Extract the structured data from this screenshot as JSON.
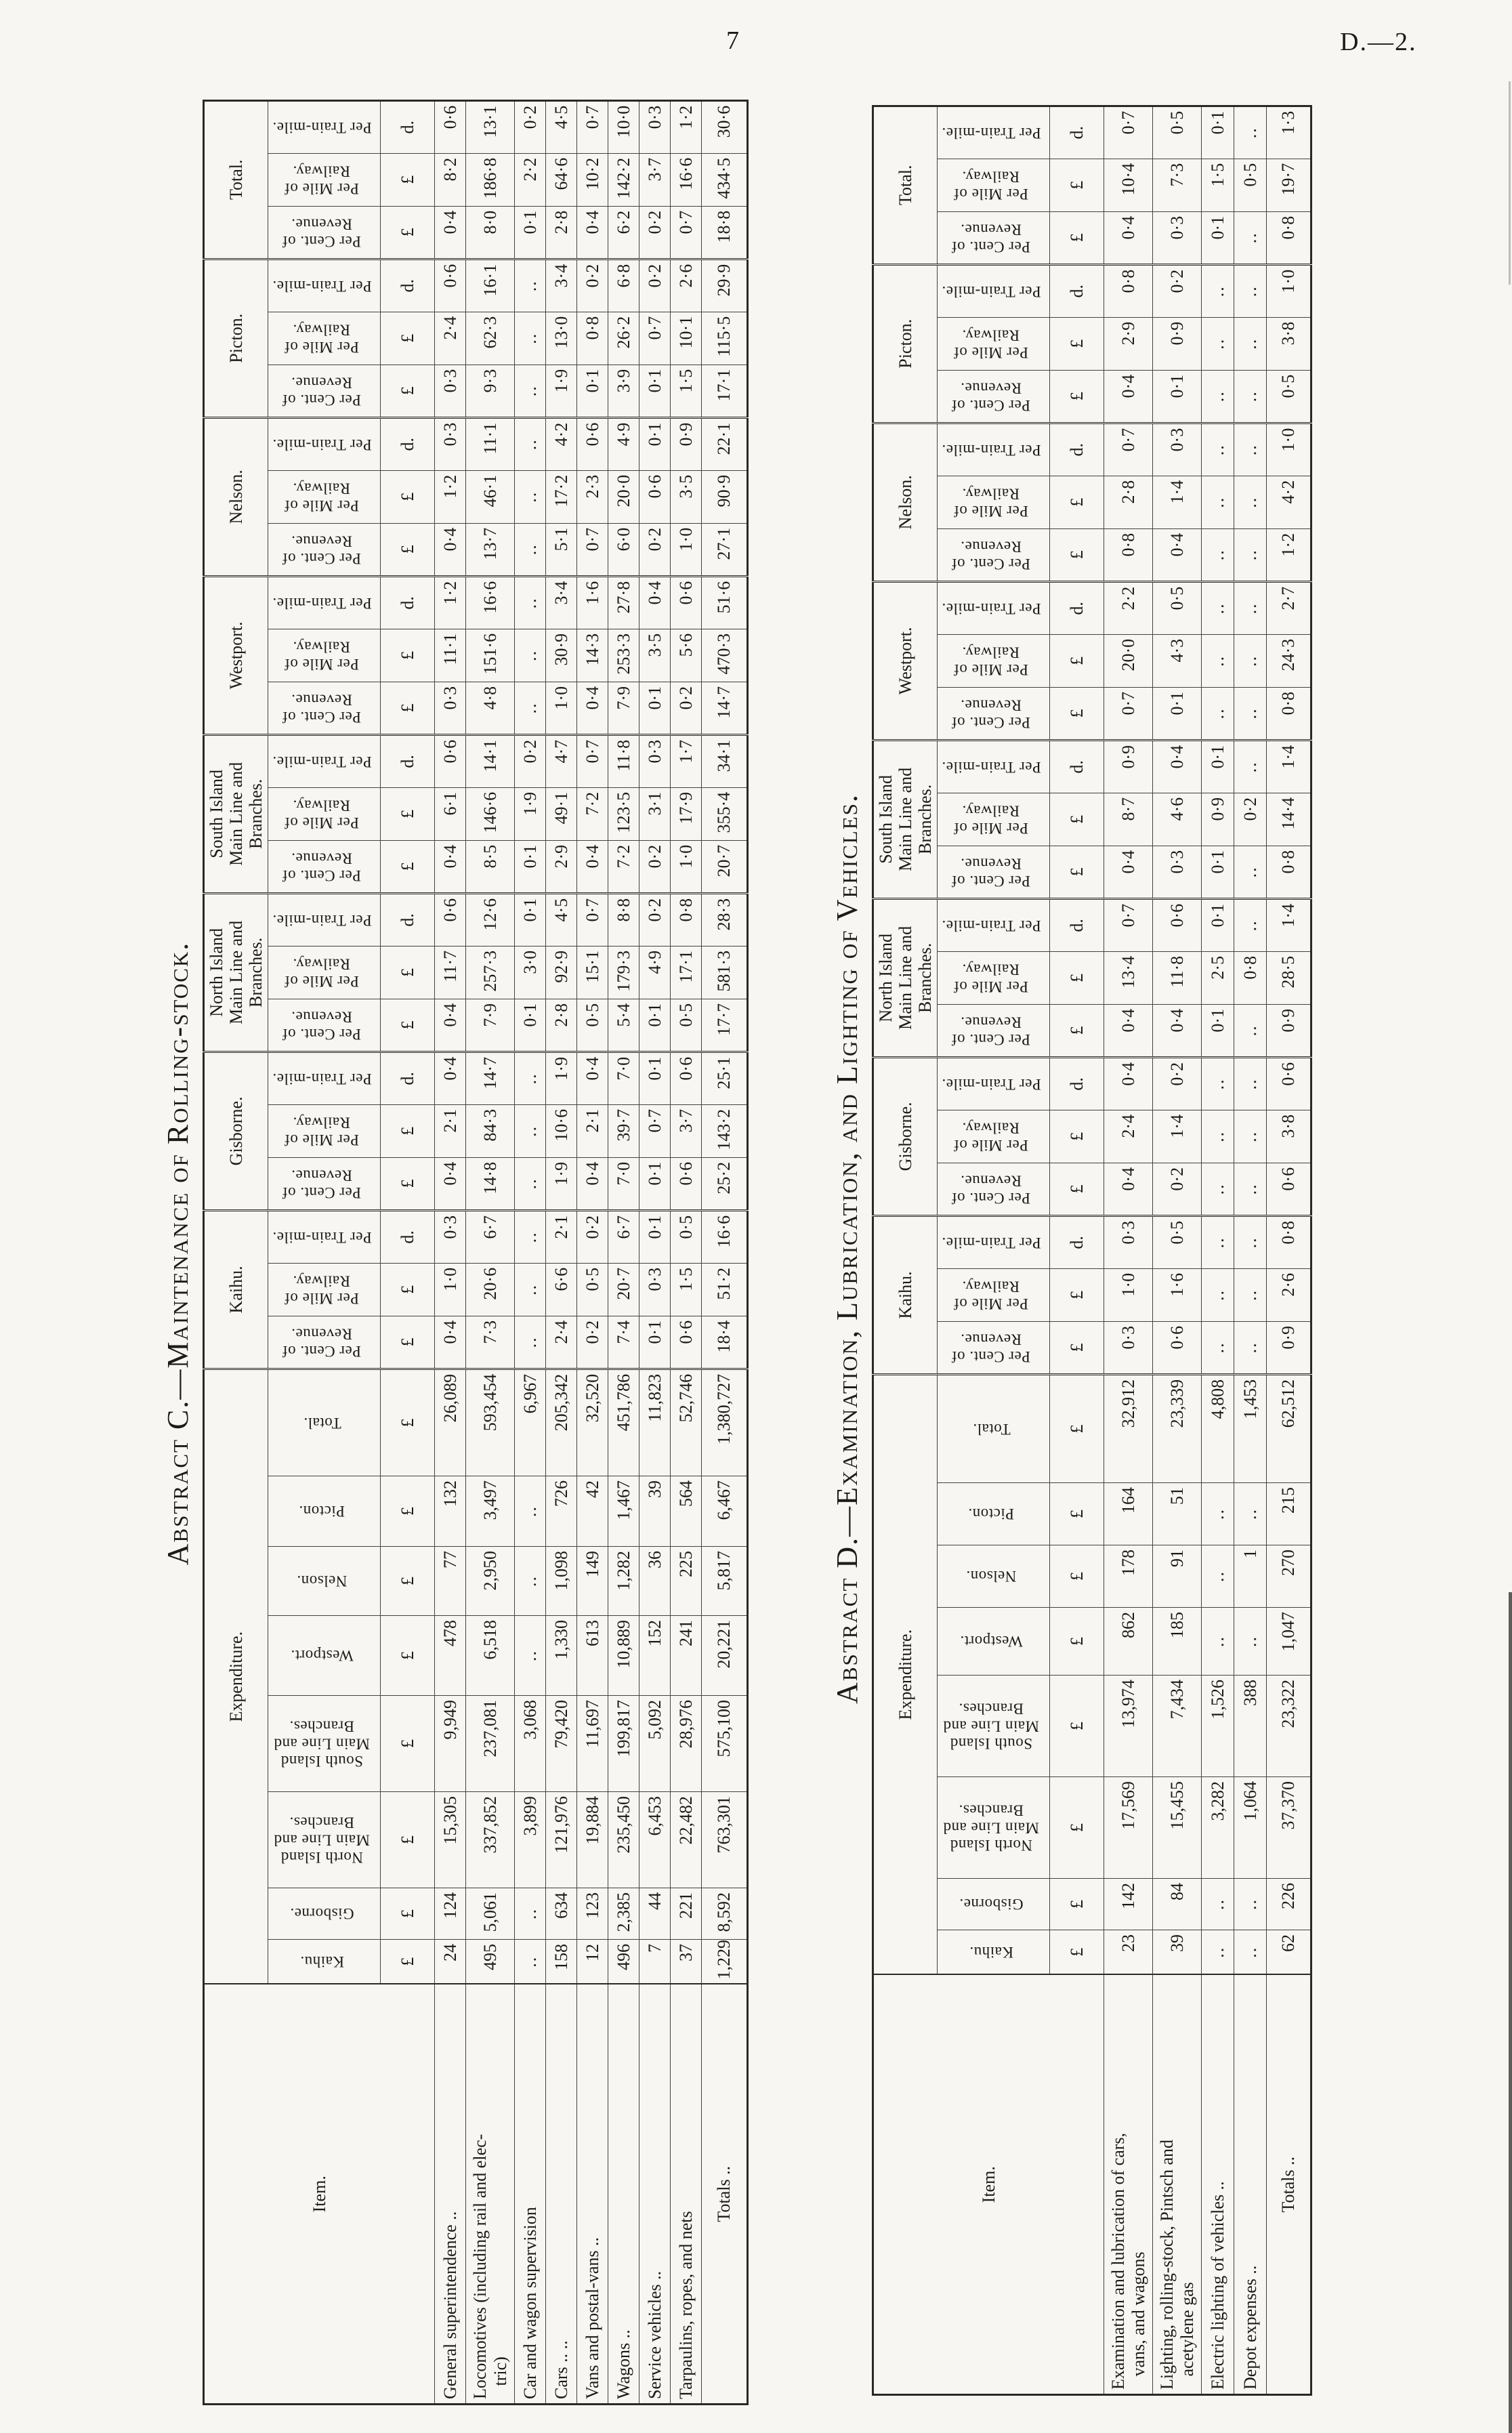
{
  "page": {
    "number": "7",
    "doc_ref": "D.—2."
  },
  "abstract_c": {
    "title": "Abstract C.—Maintenance of Rolling-stock.",
    "item_header": "Item.",
    "expenditure_header": "Expenditure.",
    "unit_pound": "£",
    "unit_pence": "d.",
    "blank": "..",
    "exp_columns": [
      "Kaihu.",
      "Gisborne.",
      "North Island\nMain Line and\nBranches.",
      "South Island\nMain Line and\nBranches.",
      "Westport.",
      "Nelson.",
      "Picton.",
      "Total."
    ],
    "ratio_groups": [
      "Kaihu.",
      "Gisborne.",
      "North Island\nMain Line and\nBranches.",
      "South Island\nMain Line and\nBranches.",
      "Westport.",
      "Nelson.",
      "Picton.",
      "Total."
    ],
    "ratio_subheaders": [
      "Per Cent. of Revenue.",
      "Per Mile of Railway.",
      "Per Train-mile."
    ],
    "rows": [
      {
        "item": "General superintendence ..",
        "exp": [
          "24",
          "124",
          "15,305",
          "9,949",
          "478",
          "77",
          "132",
          "26,089"
        ],
        "ratios": [
          [
            "0·4",
            "1·0",
            "0·3"
          ],
          [
            "0·4",
            "2·1",
            "0·4"
          ],
          [
            "0·4",
            "11·7",
            "0·6"
          ],
          [
            "0·4",
            "6·1",
            "0·6"
          ],
          [
            "0·3",
            "11·1",
            "1·2"
          ],
          [
            "0·4",
            "1·2",
            "0·3"
          ],
          [
            "0·3",
            "2·4",
            "0·6"
          ],
          [
            "0·4",
            "8·2",
            "0·6"
          ]
        ]
      },
      {
        "item": "Locomotives (including rail and elec-\n   tric)",
        "exp": [
          "495",
          "5,061",
          "337,852",
          "237,081",
          "6,518",
          "2,950",
          "3,497",
          "593,454"
        ],
        "ratios": [
          [
            "7·3",
            "20·6",
            "6·7"
          ],
          [
            "14·8",
            "84·3",
            "14·7"
          ],
          [
            "7·9",
            "257·3",
            "12·6"
          ],
          [
            "8·5",
            "146·6",
            "14·1"
          ],
          [
            "4·8",
            "151·6",
            "16·6"
          ],
          [
            "13·7",
            "46·1",
            "11·1"
          ],
          [
            "9·3",
            "62·3",
            "16·1"
          ],
          [
            "8·0",
            "186·8",
            "13·1"
          ]
        ]
      },
      {
        "item": "Car and wagon supervision",
        "exp": [
          "..",
          "..",
          "3,899",
          "3,068",
          "..",
          "..",
          "..",
          "6,967"
        ],
        "ratios": [
          [
            "..",
            "..",
            ".."
          ],
          [
            "..",
            "..",
            ".."
          ],
          [
            "0·1",
            "3·0",
            "0·1"
          ],
          [
            "0·1",
            "1·9",
            "0·2"
          ],
          [
            "..",
            "..",
            ".."
          ],
          [
            "..",
            "..",
            ".."
          ],
          [
            "..",
            "..",
            ".."
          ],
          [
            "0·1",
            "2·2",
            "0·2"
          ]
        ]
      },
      {
        "item": "Cars .. ..",
        "exp": [
          "158",
          "634",
          "121,976",
          "79,420",
          "1,330",
          "1,098",
          "726",
          "205,342"
        ],
        "ratios": [
          [
            "2·4",
            "6·6",
            "2·1"
          ],
          [
            "1·9",
            "10·6",
            "1·9"
          ],
          [
            "2·8",
            "92·9",
            "4·5"
          ],
          [
            "2·9",
            "49·1",
            "4·7"
          ],
          [
            "1·0",
            "30·9",
            "3·4"
          ],
          [
            "5·1",
            "17·2",
            "4·2"
          ],
          [
            "1·9",
            "13·0",
            "3·4"
          ],
          [
            "2·8",
            "64·6",
            "4·5"
          ]
        ]
      },
      {
        "item": "Vans and postal-vans ..",
        "exp": [
          "12",
          "123",
          "19,884",
          "11,697",
          "613",
          "149",
          "42",
          "32,520"
        ],
        "ratios": [
          [
            "0·2",
            "0·5",
            "0·2"
          ],
          [
            "0·4",
            "2·1",
            "0·4"
          ],
          [
            "0·5",
            "15·1",
            "0·7"
          ],
          [
            "0·4",
            "7·2",
            "0·7"
          ],
          [
            "0·4",
            "14·3",
            "1·6"
          ],
          [
            "0·7",
            "2·3",
            "0·6"
          ],
          [
            "0·1",
            "0·8",
            "0·2"
          ],
          [
            "0·4",
            "10·2",
            "0·7"
          ]
        ]
      },
      {
        "item": "Wagons ..",
        "exp": [
          "496",
          "2,385",
          "235,450",
          "199,817",
          "10,889",
          "1,282",
          "1,467",
          "451,786"
        ],
        "ratios": [
          [
            "7·4",
            "20·7",
            "6·7"
          ],
          [
            "7·0",
            "39·7",
            "7·0"
          ],
          [
            "5·4",
            "179·3",
            "8·8"
          ],
          [
            "7·2",
            "123·5",
            "11·8"
          ],
          [
            "7·9",
            "253·3",
            "27·8"
          ],
          [
            "6·0",
            "20·0",
            "4·9"
          ],
          [
            "3·9",
            "26·2",
            "6·8"
          ],
          [
            "6·2",
            "142·2",
            "10·0"
          ]
        ]
      },
      {
        "item": "Service vehicles ..",
        "exp": [
          "7",
          "44",
          "6,453",
          "5,092",
          "152",
          "36",
          "39",
          "11,823"
        ],
        "ratios": [
          [
            "0·1",
            "0·3",
            "0·1"
          ],
          [
            "0·1",
            "0·7",
            "0·1"
          ],
          [
            "0·1",
            "4·9",
            "0·2"
          ],
          [
            "0·2",
            "3·1",
            "0·3"
          ],
          [
            "0·1",
            "3·5",
            "0·4"
          ],
          [
            "0·2",
            "0·6",
            "0·1"
          ],
          [
            "0·1",
            "0·7",
            "0·2"
          ],
          [
            "0·2",
            "3·7",
            "0·3"
          ]
        ]
      },
      {
        "item": "Tarpaulins, ropes, and nets",
        "exp": [
          "37",
          "221",
          "22,482",
          "28,976",
          "241",
          "225",
          "564",
          "52,746"
        ],
        "ratios": [
          [
            "0·6",
            "1·5",
            "0·5"
          ],
          [
            "0·6",
            "3·7",
            "0·6"
          ],
          [
            "0·5",
            "17·1",
            "0·8"
          ],
          [
            "1·0",
            "17·9",
            "1·7"
          ],
          [
            "0·2",
            "5·6",
            "0·6"
          ],
          [
            "1·0",
            "3·5",
            "0·9"
          ],
          [
            "1·5",
            "10·1",
            "2·6"
          ],
          [
            "0·7",
            "16·6",
            "1·2"
          ]
        ]
      }
    ],
    "totals_row": {
      "item": "Totals ..",
      "exp": [
        "1,229",
        "8,592",
        "763,301",
        "575,100",
        "20,221",
        "5,817",
        "6,467",
        "1,380,727"
      ],
      "ratios": [
        [
          "18·4",
          "51·2",
          "16·6"
        ],
        [
          "25·2",
          "143·2",
          "25·1"
        ],
        [
          "17·7",
          "581·3",
          "28·3"
        ],
        [
          "20·7",
          "355·4",
          "34·1"
        ],
        [
          "14·7",
          "470·3",
          "51·6"
        ],
        [
          "27·1",
          "90·9",
          "22·1"
        ],
        [
          "17·1",
          "115·5",
          "29·9"
        ],
        [
          "18·8",
          "434·5",
          "30·6"
        ]
      ]
    }
  },
  "abstract_d": {
    "title": "Abstract D.—Examination, Lubrication, and Lighting of Vehicles.",
    "item_header": "Item.",
    "expenditure_header": "Expenditure.",
    "unit_pound": "£",
    "unit_pence": "d.",
    "blank": "..",
    "exp_columns": [
      "Kaihu.",
      "Gisborne.",
      "North Island\nMain Line and\nBranches.",
      "South Island\nMain Line and\nBranches.",
      "Westport.",
      "Nelson.",
      "Picton.",
      "Total."
    ],
    "ratio_groups": [
      "Kaihu.",
      "Gisborne.",
      "North Island\nMain Line and\nBranches.",
      "South Island\nMain Line and\nBranches.",
      "Westport.",
      "Nelson.",
      "Picton.",
      "Total."
    ],
    "ratio_subheaders": [
      "Per Cent. of Revenue.",
      "Per Mile of Railway.",
      "Per Train-mile."
    ],
    "rows": [
      {
        "item": "Examination and lubrication of cars,\n   vans, and wagons",
        "exp": [
          "23",
          "142",
          "17,569",
          "13,974",
          "862",
          "178",
          "164",
          "32,912"
        ],
        "ratios": [
          [
            "0·3",
            "1·0",
            "0·3"
          ],
          [
            "0·4",
            "2·4",
            "0·4"
          ],
          [
            "0·4",
            "13·4",
            "0·7"
          ],
          [
            "0·4",
            "8·7",
            "0·9"
          ],
          [
            "0·7",
            "20·0",
            "2·2"
          ],
          [
            "0·8",
            "2·8",
            "0·7"
          ],
          [
            "0·4",
            "2·9",
            "0·8"
          ],
          [
            "0·4",
            "10·4",
            "0·7"
          ]
        ]
      },
      {
        "item": "Lighting, rolling-stock, Pintsch and\n   acetylene gas",
        "exp": [
          "39",
          "84",
          "15,455",
          "7,434",
          "185",
          "91",
          "51",
          "23,339"
        ],
        "ratios": [
          [
            "0·6",
            "1·6",
            "0·5"
          ],
          [
            "0·2",
            "1·4",
            "0·2"
          ],
          [
            "0·4",
            "11·8",
            "0·6"
          ],
          [
            "0·3",
            "4·6",
            "0·4"
          ],
          [
            "0·1",
            "4·3",
            "0·5"
          ],
          [
            "0·4",
            "1·4",
            "0·3"
          ],
          [
            "0·1",
            "0·9",
            "0·2"
          ],
          [
            "0·3",
            "7·3",
            "0·5"
          ]
        ]
      },
      {
        "item": "Electric lighting of vehicles ..",
        "exp": [
          "..",
          "..",
          "3,282",
          "1,526",
          "..",
          "..",
          "..",
          "4,808"
        ],
        "ratios": [
          [
            "..",
            "..",
            ".."
          ],
          [
            "..",
            "..",
            ".."
          ],
          [
            "0·1",
            "2·5",
            "0·1"
          ],
          [
            "0·1",
            "0·9",
            "0·1"
          ],
          [
            "..",
            "..",
            ".."
          ],
          [
            "..",
            "..",
            ".."
          ],
          [
            "..",
            "..",
            ".."
          ],
          [
            "0·1",
            "1·5",
            "0·1"
          ]
        ]
      },
      {
        "item": "Depot expenses ..",
        "exp": [
          "..",
          "..",
          "1,064",
          "388",
          "..",
          "1",
          "..",
          "1,453"
        ],
        "ratios": [
          [
            "..",
            "..",
            ".."
          ],
          [
            "..",
            "..",
            ".."
          ],
          [
            "..",
            "0·8",
            ".."
          ],
          [
            "..",
            "0·2",
            ".."
          ],
          [
            "..",
            "..",
            ".."
          ],
          [
            "..",
            "..",
            ".."
          ],
          [
            "..",
            "..",
            ".."
          ],
          [
            "..",
            "0·5",
            ".."
          ]
        ]
      }
    ],
    "totals_row": {
      "item": "Totals ..",
      "exp": [
        "62",
        "226",
        "37,370",
        "23,322",
        "1,047",
        "270",
        "215",
        "62,512"
      ],
      "ratios": [
        [
          "0·9",
          "2·6",
          "0·8"
        ],
        [
          "0·6",
          "3·8",
          "0·6"
        ],
        [
          "0·9",
          "28·5",
          "1·4"
        ],
        [
          "0·8",
          "14·4",
          "1·4"
        ],
        [
          "0·8",
          "24·3",
          "2·7"
        ],
        [
          "1·2",
          "4·2",
          "1·0"
        ],
        [
          "0·5",
          "3·8",
          "1·0"
        ],
        [
          "0·8",
          "19·7",
          "1·3"
        ]
      ]
    }
  }
}
